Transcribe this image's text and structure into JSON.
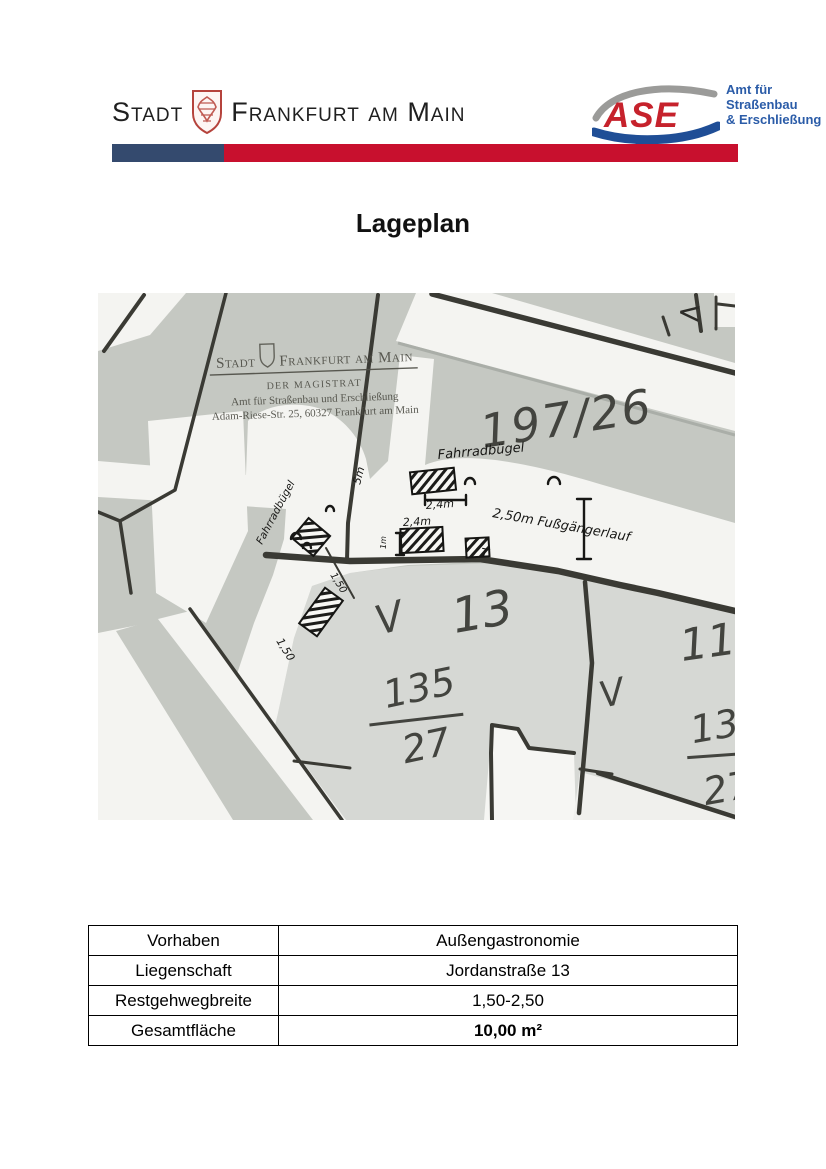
{
  "title": "Lageplan",
  "header": {
    "city_logo": {
      "stadt": "Stadt",
      "frankfurt_am_main": "Frankfurt am Main"
    },
    "ase_logo": {
      "abbr": "ASE",
      "lines": [
        "Amt für",
        "Straßenbau",
        "& Erschließung"
      ],
      "red": "#c6222c",
      "blue": "#2b5ca8",
      "gray": "#9b9b99"
    },
    "bar": {
      "blue": "#344a6e",
      "red": "#c8102e"
    }
  },
  "map": {
    "stamp": {
      "stadt": "Stadt",
      "frankfurt_am_main": "Frankfurt am Main",
      "magistrat": "DER MAGISTRAT",
      "amt": "Amt für Straßenbau und Erschließung",
      "address": "Adam-Riese-Str. 25, 60327 Frankfurt am Main"
    },
    "labels": {
      "parcel_197": "197/26",
      "house_13": "13",
      "storeys_left": "V",
      "flur_135": "135",
      "flur_27": "27",
      "house_11": "11",
      "storeys_right": "V",
      "flur_13_right": "13",
      "flur_27_right": "27",
      "passage_arrow": "<"
    },
    "annotations": {
      "fahrradbuegel_top": "Fahrradbügel",
      "fahrradbuegel_left": "Fahrradbügel",
      "width_24_top": "2,4m",
      "width_24_bottom": "2,4m",
      "walkway": "2,50m Fußgängerlauf",
      "width_150_sidewalk": "1,50",
      "width_150_hatch": "1,50",
      "width_5": "5m",
      "depth_1m": "1m",
      "t_mark": "T"
    },
    "colors": {
      "parcel_gray": "#c5c8c2",
      "parcel_light": "#d6d8d4",
      "street_white": "#f4f4f1",
      "line_dark": "#3a3a34",
      "ink": "#171715"
    }
  },
  "table": {
    "rows": [
      {
        "label": "Vorhaben",
        "value": "Außengastronomie"
      },
      {
        "label": "Liegenschaft",
        "value": "Jordanstraße 13"
      },
      {
        "label": "Restgehwegbreite",
        "value": "1,50-2,50"
      },
      {
        "label": "Gesamtfläche",
        "value": "10,00 m²"
      }
    ]
  }
}
